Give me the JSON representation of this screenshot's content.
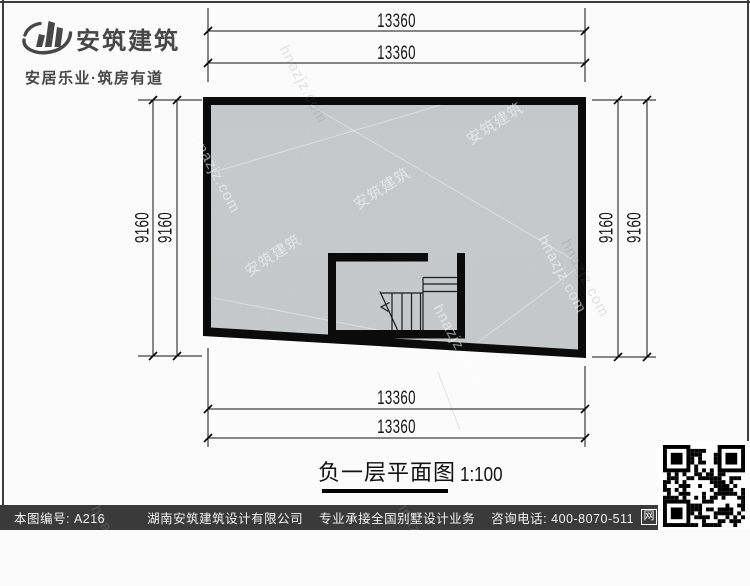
{
  "logo": {
    "name": "安筑建筑",
    "tagline": "安居乐业·筑房有道"
  },
  "drawing": {
    "title": "负一层平面图",
    "scale": "1:100",
    "dims": {
      "top": [
        "13360",
        "13360"
      ],
      "bottom": [
        "13360",
        "13360"
      ],
      "left": [
        "9160",
        "9160"
      ],
      "right": [
        "9160",
        "9160"
      ]
    },
    "watermarks": {
      "cn": "安筑建筑",
      "url": "hnazjz.com"
    }
  },
  "footer": {
    "sheet_no": "本图编号: A216",
    "company": "湖南安筑建筑设计有限公司",
    "service": "专业承接全国别墅设计业务",
    "phone": "咨询电话: 400-8070-511",
    "web_badge": "网"
  },
  "colors": {
    "wall": "#0b0b0b",
    "floor": "#c7c9ca",
    "footer_bg": "#3a3a3a",
    "logo_text": "#474747"
  }
}
